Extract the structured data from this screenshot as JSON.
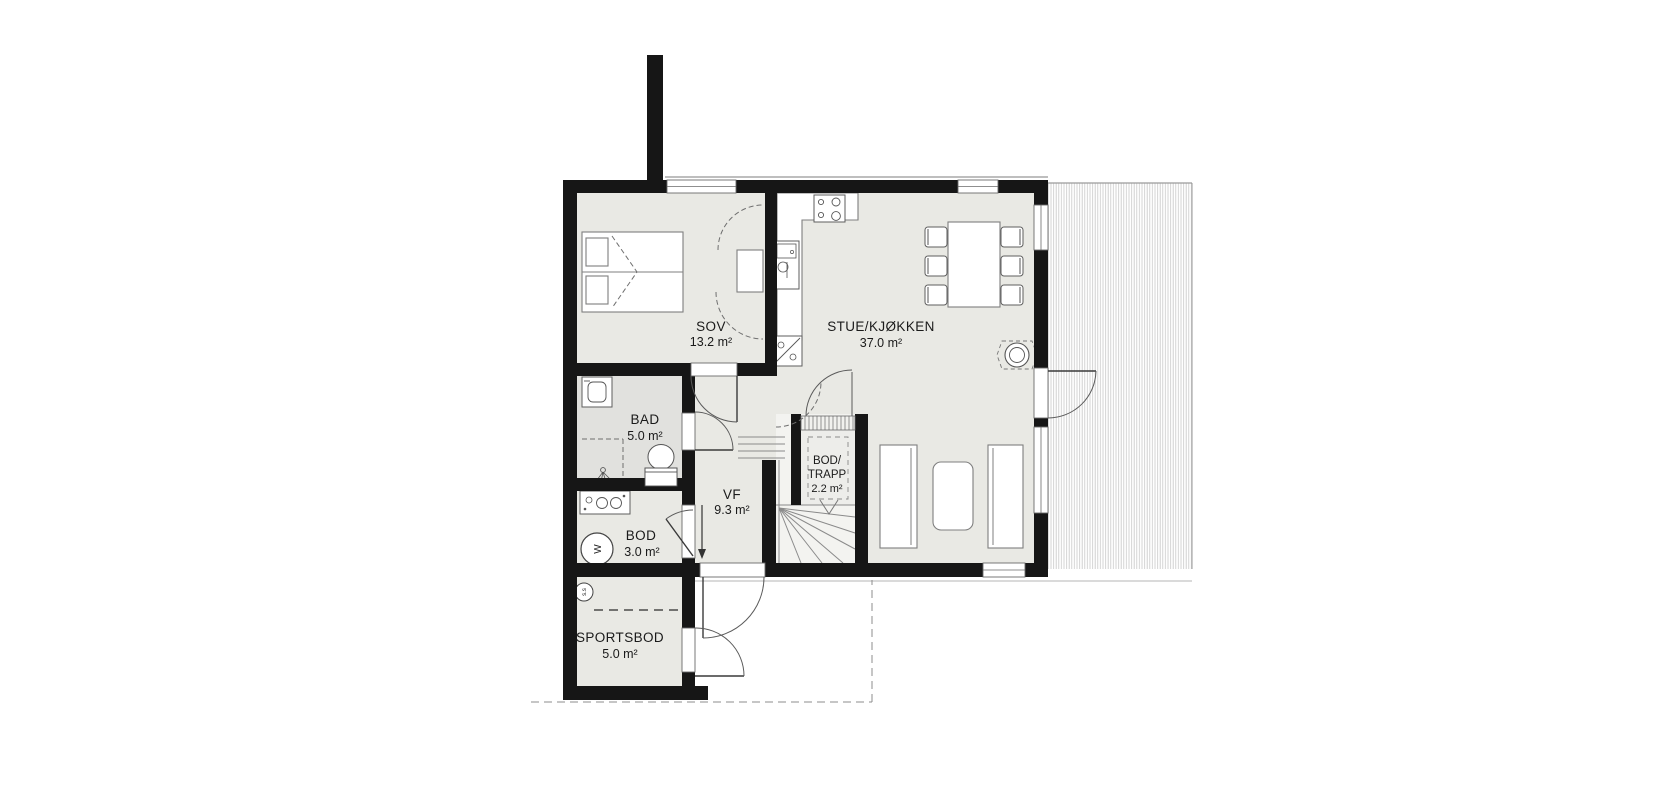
{
  "plan": {
    "rooms": [
      {
        "name": "SOV",
        "area": "13.2 m²"
      },
      {
        "name": "STUE/KJØKKEN",
        "area": "37.0 m²"
      },
      {
        "name": "BAD",
        "area": "5.0 m²"
      },
      {
        "name": "VF",
        "area": "9.3 m²"
      },
      {
        "name": "BOD/",
        "name_line2": "TRAPP",
        "area": "2.2 m²"
      },
      {
        "name": "BOD",
        "area": "3.0 m²"
      },
      {
        "name": "SPORTSBOD",
        "area": "5.0 m²"
      }
    ],
    "symbols": {
      "water_heater": "W",
      "floor_drain": "s.s"
    },
    "furniture_icons": [
      "double-bed",
      "wardrobe",
      "cooktop",
      "kitchen-sink",
      "fridge",
      "dining-table",
      "chairs",
      "wood-stove",
      "sofa",
      "coffee-table",
      "washing-machine",
      "toilet",
      "shower",
      "vanity-basins",
      "stairs-winder",
      "direction-arrow"
    ],
    "colors": {
      "wall": "#161616",
      "floor": "#e9e9e4",
      "floor_bathroom": "#e1e1de",
      "stair_floor": "#f3f3f0",
      "deck_hatch": "#c9c9c9",
      "outline": "#7f7f7f",
      "background": "#ffffff"
    }
  }
}
